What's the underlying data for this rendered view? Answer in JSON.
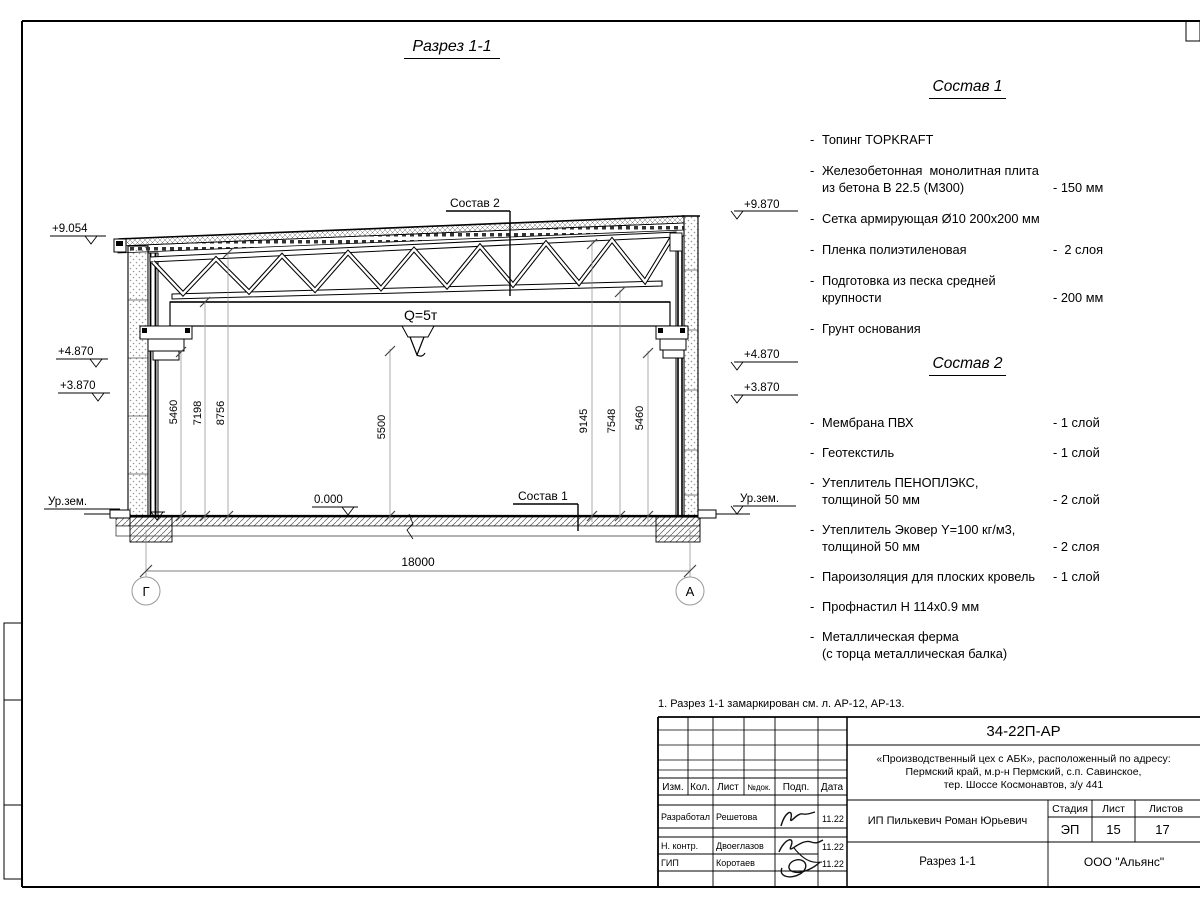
{
  "sheet": {
    "title": "Разрез 1-1",
    "note": "1. Разрез 1-1 замаркирован см. л. АР-12, АР-13."
  },
  "section": {
    "callout_roof": "Состав 2",
    "callout_floor": "Состав 1",
    "crane_capacity": "Q=5т",
    "axis_left": "Г",
    "axis_right": "А",
    "span_dim": "18000",
    "floor_level": "0.000",
    "ground_left": "Ур.зем.",
    "ground_right": "Ур.зем.",
    "elev_left": [
      "+9.054",
      "+4.870",
      "+3.870"
    ],
    "elev_right": [
      "+9.870",
      "+4.870",
      "+3.870"
    ],
    "dims_left": [
      "5460",
      "7198",
      "8756"
    ],
    "dim_center": "5500",
    "dims_right": [
      "9145",
      "7548",
      "5460"
    ]
  },
  "sostav1": {
    "title": "Состав 1",
    "items": [
      {
        "text": "Топинг TOPKRAFT",
        "value": ""
      },
      {
        "text": "Железобетонная  монолитная плита\nиз бетона В 22.5 (М300)",
        "value": "- 150 мм"
      },
      {
        "text": "Сетка армирующая Ø10 200х200 мм",
        "value": ""
      },
      {
        "text": "Пленка полиэтиленовая",
        "value": "-  2 слоя"
      },
      {
        "text": "Подготовка из песка средней\nкрупности",
        "value": "- 200 мм"
      },
      {
        "text": "Грунт основания",
        "value": ""
      }
    ]
  },
  "sostav2": {
    "title": "Состав 2",
    "items": [
      {
        "text": "Мембрана ПВХ",
        "value": "- 1 слой"
      },
      {
        "text": "Геотекстиль",
        "value": "- 1 слой"
      },
      {
        "text": "Утеплитель ПЕНОПЛЭКС,\nтолщиной 50 мм",
        "value": "- 2 слой"
      },
      {
        "text": "Утеплитель Эковер Y=100 кг/м3,\nтолщиной 50 мм",
        "value": "- 2 слоя"
      },
      {
        "text": "Пароизоляция для плоских кровель",
        "value": "- 1 слой"
      },
      {
        "text": "Профнастил Н 114х0.9 мм",
        "value": ""
      },
      {
        "text": "Металлическая ферма\n(с торца металлическая балка)",
        "value": ""
      }
    ]
  },
  "titleblock": {
    "doc_number": "34-22П-АР",
    "project": "«Производственный цех с АБК», расположенный по адресу:\nПермский край, м.р-н Пермский, с.п. Савинское,\nтер. Шоссе Космонавтов, з/у 441",
    "client": "ИП Пилькевич Роман Юрьевич",
    "drawing_title": "Разрез 1-1",
    "company": "ООО \"Альянс\"",
    "columns": [
      "Изм.",
      "Кол.",
      "Лист",
      "№док.",
      "Подп.",
      "Дата"
    ],
    "stage_label": "Стадия",
    "stage": "ЭП",
    "sheet_label": "Лист",
    "sheet_number": "15",
    "sheets_label": "Листов",
    "sheets_total": "17",
    "rows": [
      {
        "role": "Разработал",
        "name": "Решетова",
        "date": "11.22"
      },
      {
        "role": "Н. контр.",
        "name": "Двоеглазов",
        "date": "11.22"
      },
      {
        "role": "ГИП",
        "name": "Коротаев",
        "date": "11.22"
      }
    ]
  }
}
